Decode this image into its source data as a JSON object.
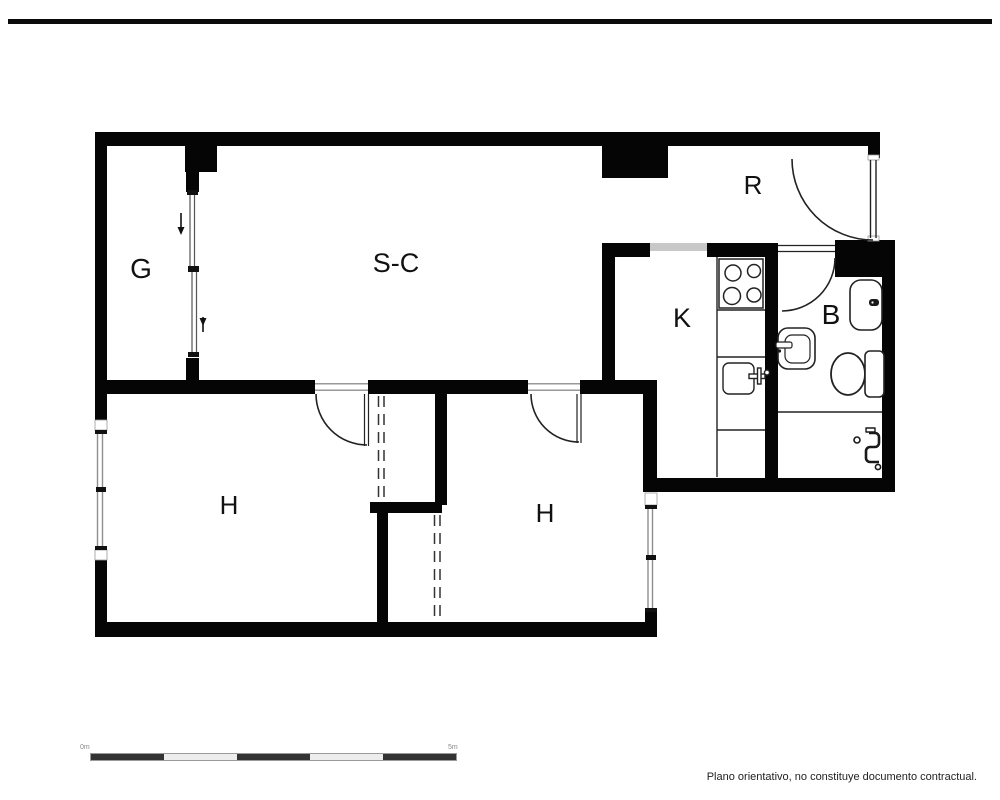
{
  "floorplan": {
    "rooms": [
      {
        "key": "room-g",
        "label": "G"
      },
      {
        "key": "salon-comedor",
        "label": "S-C"
      },
      {
        "key": "recibidor",
        "label": "R"
      },
      {
        "key": "cocina",
        "label": "K"
      },
      {
        "key": "bano",
        "label": "B"
      },
      {
        "key": "habitacion-izquierda",
        "label": "H"
      },
      {
        "key": "habitacion-derecha",
        "label": "H"
      }
    ],
    "scale_bar": {
      "start_label": "0m",
      "end_label": "5m",
      "segments": 5
    },
    "disclaimer": "Plano orientativo, no constituye documento contractual.",
    "colors": {
      "wall": "#050505",
      "floor": "#ffffff",
      "glazing": "#8f8f8f",
      "opening": "#c8c8c8",
      "fixture": "#222222",
      "scale_dark": "#333333",
      "scale_light": "#ededed"
    }
  }
}
